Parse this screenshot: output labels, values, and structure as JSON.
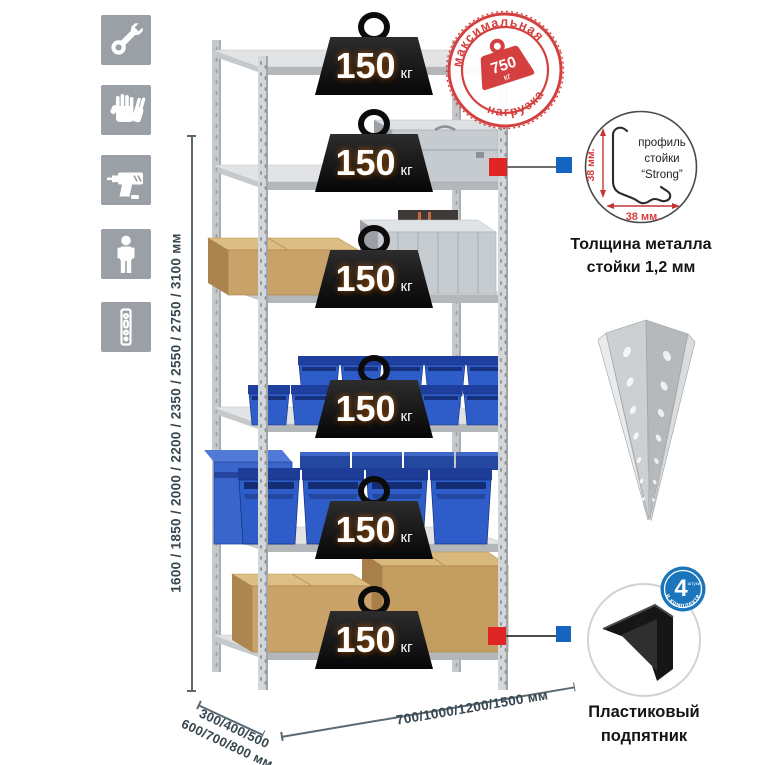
{
  "sidebar_icons": [
    "wrench-icon",
    "gloves-icon",
    "drill-icon",
    "person-icon",
    "rack-post-icon"
  ],
  "dimensions": {
    "height_label": "1600 / 1850 / 2000 / 2200 / 2350 / 2550 / 2750 / 3100 мм",
    "depth_line1": "300/400/500",
    "depth_line2": "600/700/800 мм",
    "width_label": "700/1000/1200/1500 мм"
  },
  "shelves": [
    {
      "load": "150",
      "unit": "кг"
    },
    {
      "load": "150",
      "unit": "кг"
    },
    {
      "load": "150",
      "unit": "кг"
    },
    {
      "load": "150",
      "unit": "кг"
    },
    {
      "load": "150",
      "unit": "кг"
    },
    {
      "load": "150",
      "unit": "кг"
    }
  ],
  "max_load_stamp": {
    "arc_top": "максимальная",
    "arc_bottom": "нагрузка",
    "value": "750",
    "unit": "кг"
  },
  "post_profile": {
    "label_line1": "профиль",
    "label_line2": "стойки",
    "label_line3": "“Strong”",
    "dim_vertical": "38 мм.",
    "dim_horizontal": "38 мм.",
    "caption_line1": "Толщина металла",
    "caption_line2": "стойки 1,2 мм"
  },
  "plastic_foot": {
    "caption_line1": "Пластиковый",
    "caption_line2": "подпятник",
    "badge_value": "4",
    "badge_unit": "штуки",
    "badge_arc": "в комплекте"
  },
  "colors": {
    "accent_red": "#d4403f",
    "marker_red": "#e02525",
    "marker_blue": "#1565c0",
    "badge_blue": "#1b75bb",
    "bin_blue": "#2e5cc9",
    "icon_gray": "#9aa0a5",
    "dim_text": "#37474f"
  }
}
